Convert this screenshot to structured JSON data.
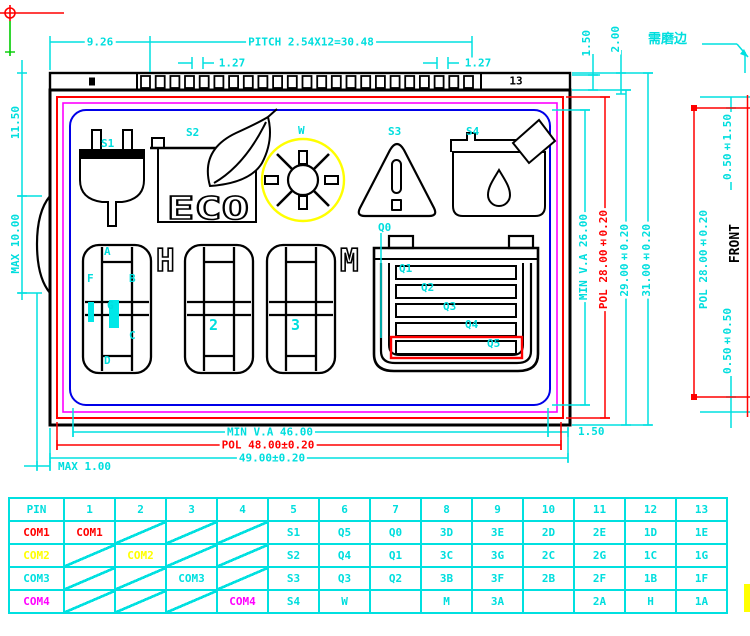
{
  "note": {
    "grind_edge": "需磨边"
  },
  "dims": {
    "top": {
      "offset": "9.26",
      "pitch": "PITCH 2.54X12=30.48",
      "half_pitch_left": "1.27",
      "half_pitch_right": "1.27",
      "pad_height": "1.50",
      "ledge": "2.00"
    },
    "left": {
      "upper": "11.50",
      "bump": "MAX 10.00"
    },
    "bottom": {
      "min_va": "MIN V.A 46.00",
      "pol": "POL 48.00±0.20",
      "glass": "49.00±0.20",
      "bump_out": "MAX 1.00",
      "side_gap": "1.50"
    },
    "right": {
      "min_va": "MIN V.A 26.00",
      "pol": "POL 28.00±0.20",
      "inner": "29.00±0.20",
      "glass": "31.00±0.20"
    },
    "side_view": {
      "front": "FRONT",
      "pol": "POL 28.00±0.20",
      "top_offset": "0.50±1.50",
      "bottom_offset": "0.50±0.50"
    }
  },
  "display": {
    "pin13": "13",
    "icons": {
      "s1": "S1",
      "s2": "S2",
      "w": "W",
      "s3": "S3",
      "s4": "S4",
      "q0": "Q0",
      "eco": "ECO"
    },
    "segments": {
      "a": "A",
      "f": "F",
      "b": "B",
      "g": "G",
      "c": "C",
      "d": "D"
    },
    "digits": {
      "d2": "2",
      "d3": "3"
    },
    "letters": {
      "h": "H",
      "m": "M"
    },
    "battery_bars": [
      "Q1",
      "Q2",
      "Q3",
      "Q4",
      "Q5"
    ]
  },
  "pin_table": {
    "col_header": "PIN",
    "pins": [
      "1",
      "2",
      "3",
      "4",
      "5",
      "6",
      "7",
      "8",
      "9",
      "10",
      "11",
      "12",
      "13"
    ],
    "rows": [
      {
        "label": "COM1",
        "cells": [
          "COM1",
          "DIAG",
          "DIAG",
          "DIAG",
          "S1",
          "Q5",
          "Q0",
          "3D",
          "3E",
          "2D",
          "2E",
          "1D",
          "1E"
        ]
      },
      {
        "label": "COM2",
        "cells": [
          "DIAG",
          "COM2",
          "DIAG",
          "DIAG",
          "S2",
          "Q4",
          "Q1",
          "3C",
          "3G",
          "2C",
          "2G",
          "1C",
          "1G"
        ]
      },
      {
        "label": "COM3",
        "cells": [
          "DIAG",
          "DIAG",
          "COM3",
          "DIAG",
          "S3",
          "Q3",
          "Q2",
          "3B",
          "3F",
          "2B",
          "2F",
          "1B",
          "1F"
        ]
      },
      {
        "label": "COM4",
        "cells": [
          "DIAG",
          "DIAG",
          "DIAG",
          "COM4",
          "S4",
          "W",
          "",
          "M",
          "3A",
          "",
          "2A",
          "H",
          "1A"
        ]
      }
    ]
  },
  "colors": {
    "dim_cyan": "#00E0E0",
    "pol_red": "#FF0000",
    "seal_magenta": "#FF00FF",
    "va_blue": "#0000E8",
    "accent_yellow": "#FFFF00",
    "origin_green": "#00CC00",
    "com1": "#FF0000",
    "com2": "#FFFF00",
    "com3": "#00E0E0",
    "com4": "#FF00FF"
  }
}
